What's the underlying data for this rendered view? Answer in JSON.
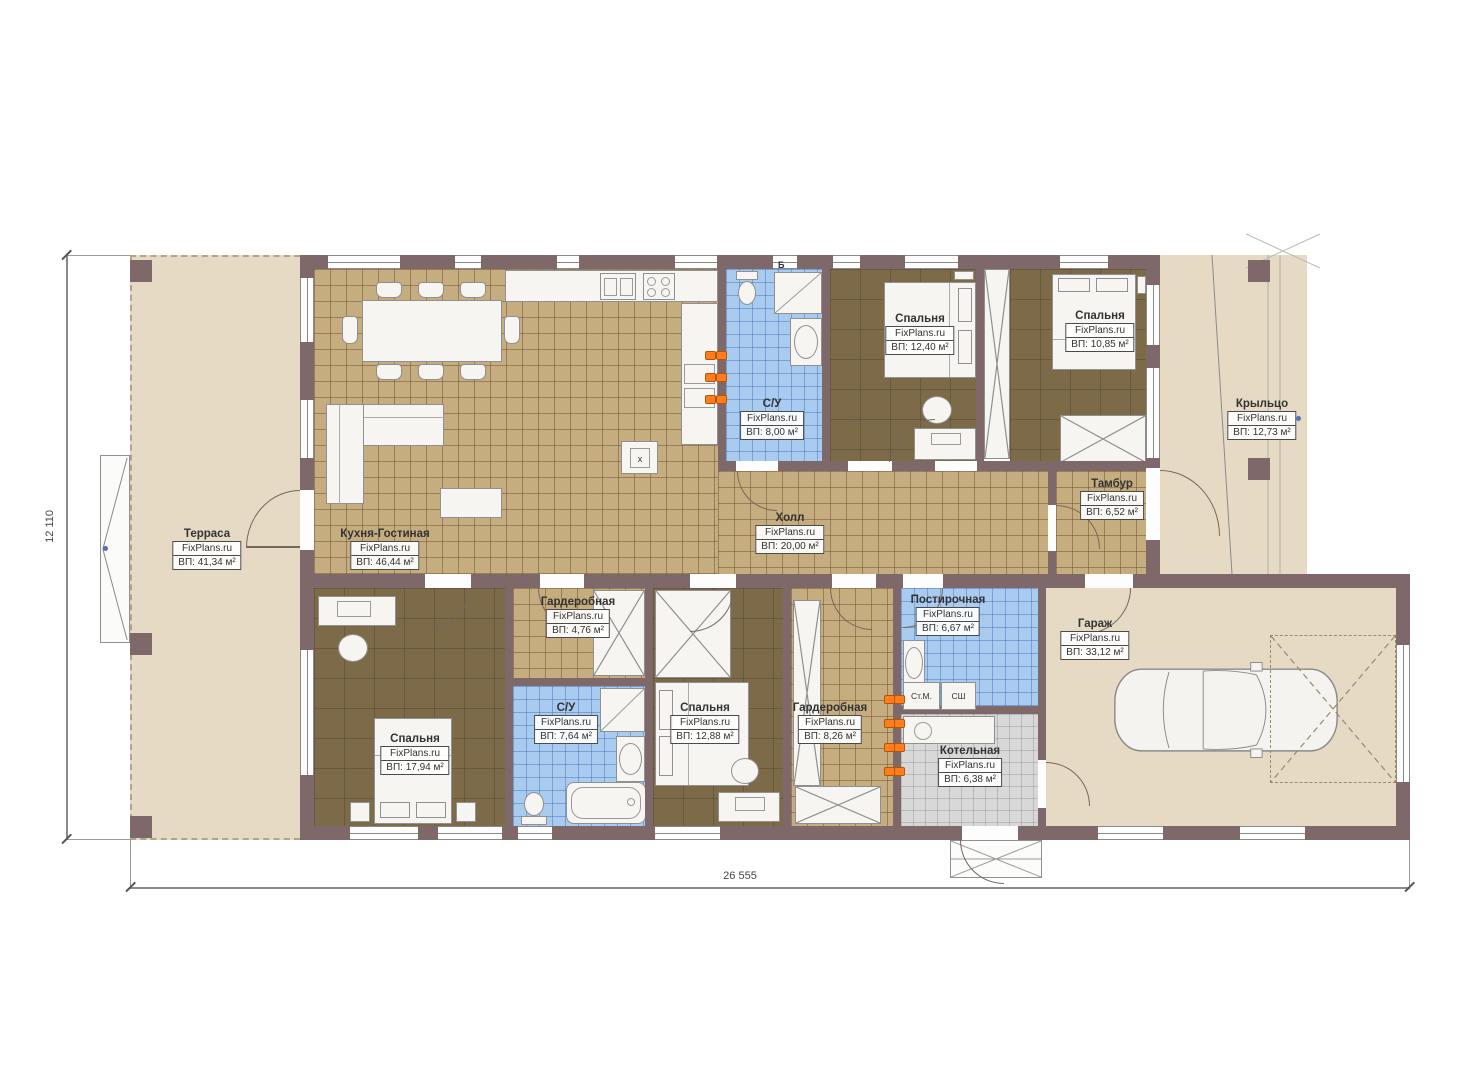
{
  "rooms": {
    "terrace": {
      "name": "Терраса",
      "brand": "FixPlans.ru",
      "area": "ВП: 41,34 м²"
    },
    "kitchen_living": {
      "name": "Кухня-Гостиная",
      "brand": "FixPlans.ru",
      "area": "ВП: 46,44 м²"
    },
    "bathroom_top": {
      "name": "С/У",
      "brand": "FixPlans.ru",
      "area": "ВП: 8,00 м²"
    },
    "bedroom_top_1": {
      "name": "Спальня",
      "brand": "FixPlans.ru",
      "area": "ВП: 12,40 м²"
    },
    "bedroom_top_2": {
      "name": "Спальня",
      "brand": "FixPlans.ru",
      "area": "ВП: 10,85 м²"
    },
    "porch": {
      "name": "Крыльцо",
      "brand": "FixPlans.ru",
      "area": "ВП: 12,73 м²"
    },
    "vestibule": {
      "name": "Тамбур",
      "brand": "FixPlans.ru",
      "area": "ВП: 6,52 м²"
    },
    "hall": {
      "name": "Холл",
      "brand": "FixPlans.ru",
      "area": "ВП: 20,00 м²"
    },
    "wardrobe_small": {
      "name": "Гардеробная",
      "brand": "FixPlans.ru",
      "area": "ВП: 4,76 м²"
    },
    "bedroom_master": {
      "name": "Спальня",
      "brand": "FixPlans.ru",
      "area": "ВП: 17,94 м²"
    },
    "bathroom_bottom": {
      "name": "С/У",
      "brand": "FixPlans.ru",
      "area": "ВП: 7,64 м²"
    },
    "bedroom_bottom": {
      "name": "Спальня",
      "brand": "FixPlans.ru",
      "area": "ВП: 12,88 м²"
    },
    "wardrobe_big": {
      "name": "Гардеробная",
      "brand": "FixPlans.ru",
      "area": "ВП: 8,26 м²"
    },
    "laundry": {
      "name": "Постирочная",
      "brand": "FixPlans.ru",
      "area": "ВП: 6,67 м²"
    },
    "boiler": {
      "name": "Котельная",
      "brand": "FixPlans.ru",
      "area": "ВП: 6,38 м²"
    },
    "garage": {
      "name": "Гараж",
      "brand": "FixPlans.ru",
      "area": "ВП: 33,12 м²"
    }
  },
  "appliances": {
    "washer": "Ст.М.",
    "dryer": "СШ",
    "kitchen_unit": "x",
    "water_heater": "Б"
  },
  "dimensions": {
    "horizontal": "26 555",
    "vertical": "12 110"
  },
  "colors": {
    "wall": "#7e686a",
    "terrace_floor": "#e6dac5",
    "wood_tile": "#c6ad80",
    "bedroom_floor": "#7d6a49",
    "wet_tile": "#a9cbf0",
    "tech_tile": "#d8d8d8",
    "accent_orange": "#ff7d1f"
  }
}
